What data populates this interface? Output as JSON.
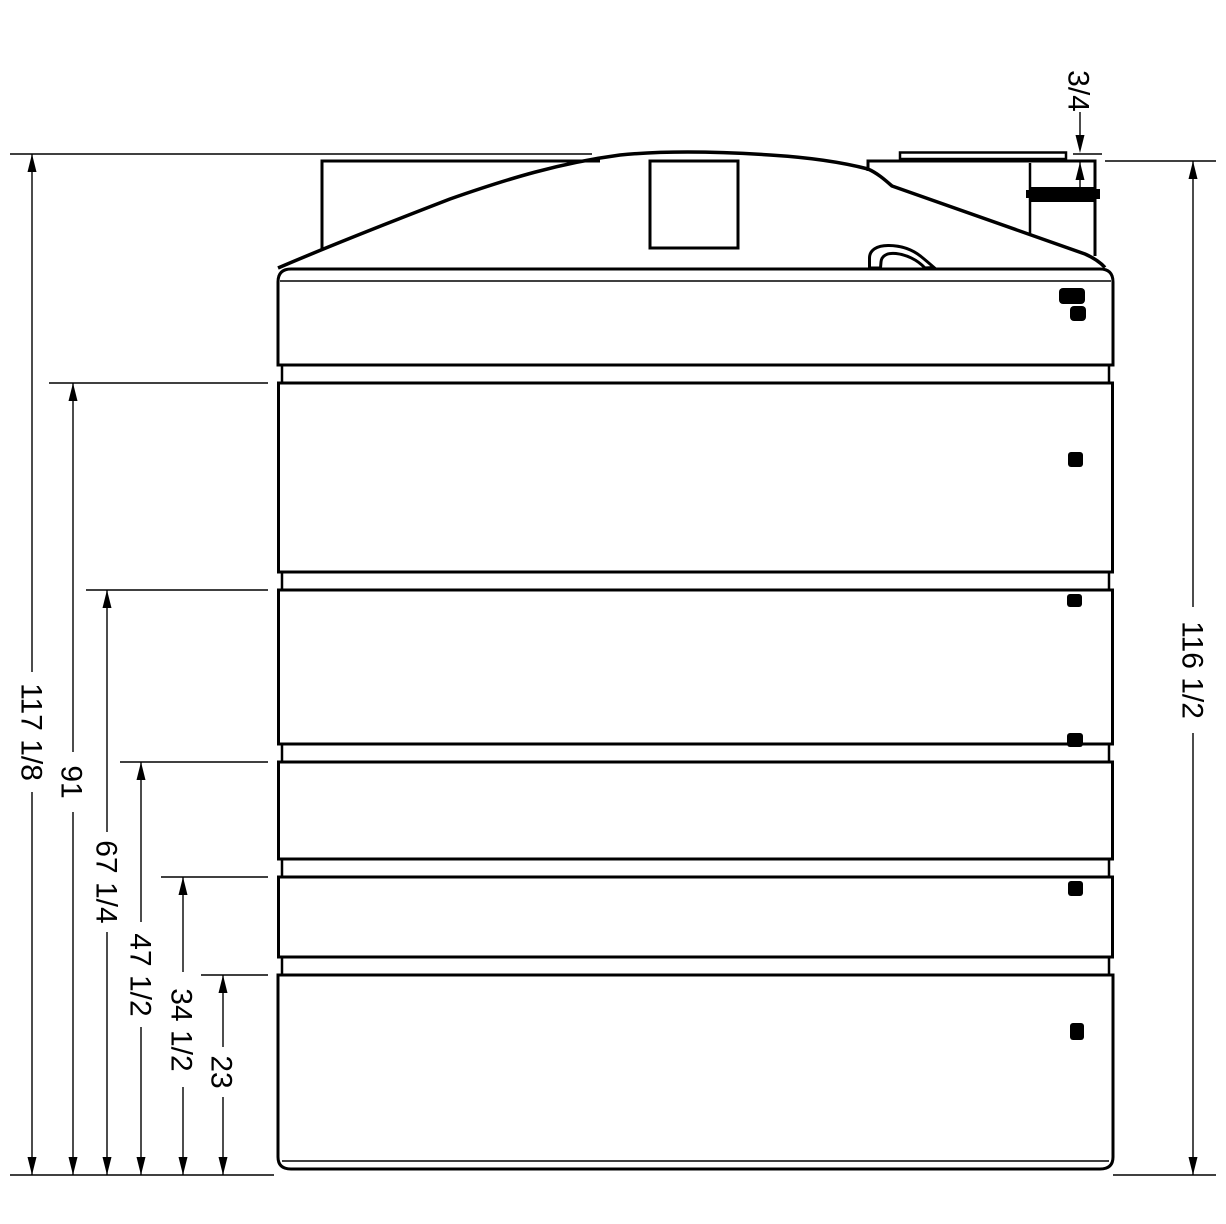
{
  "drawing": {
    "background_color": "#ffffff",
    "stroke_color": "#000000",
    "thread_fill_color": "#000000"
  },
  "dimensions": {
    "left": [
      {
        "id": "overall-height",
        "label": "117 1/8"
      },
      {
        "id": "height-91",
        "label": "91"
      },
      {
        "id": "height-67-1-4",
        "label": "67 1/4"
      },
      {
        "id": "height-47-1-2",
        "label": "47 1/2"
      },
      {
        "id": "height-34-1-2",
        "label": "34 1/2"
      },
      {
        "id": "height-23",
        "label": "23"
      }
    ],
    "right": [
      {
        "id": "height-116-1-2",
        "label": "116 1/2"
      }
    ],
    "top": [
      {
        "id": "fitting-height",
        "label": "3/4"
      }
    ]
  }
}
